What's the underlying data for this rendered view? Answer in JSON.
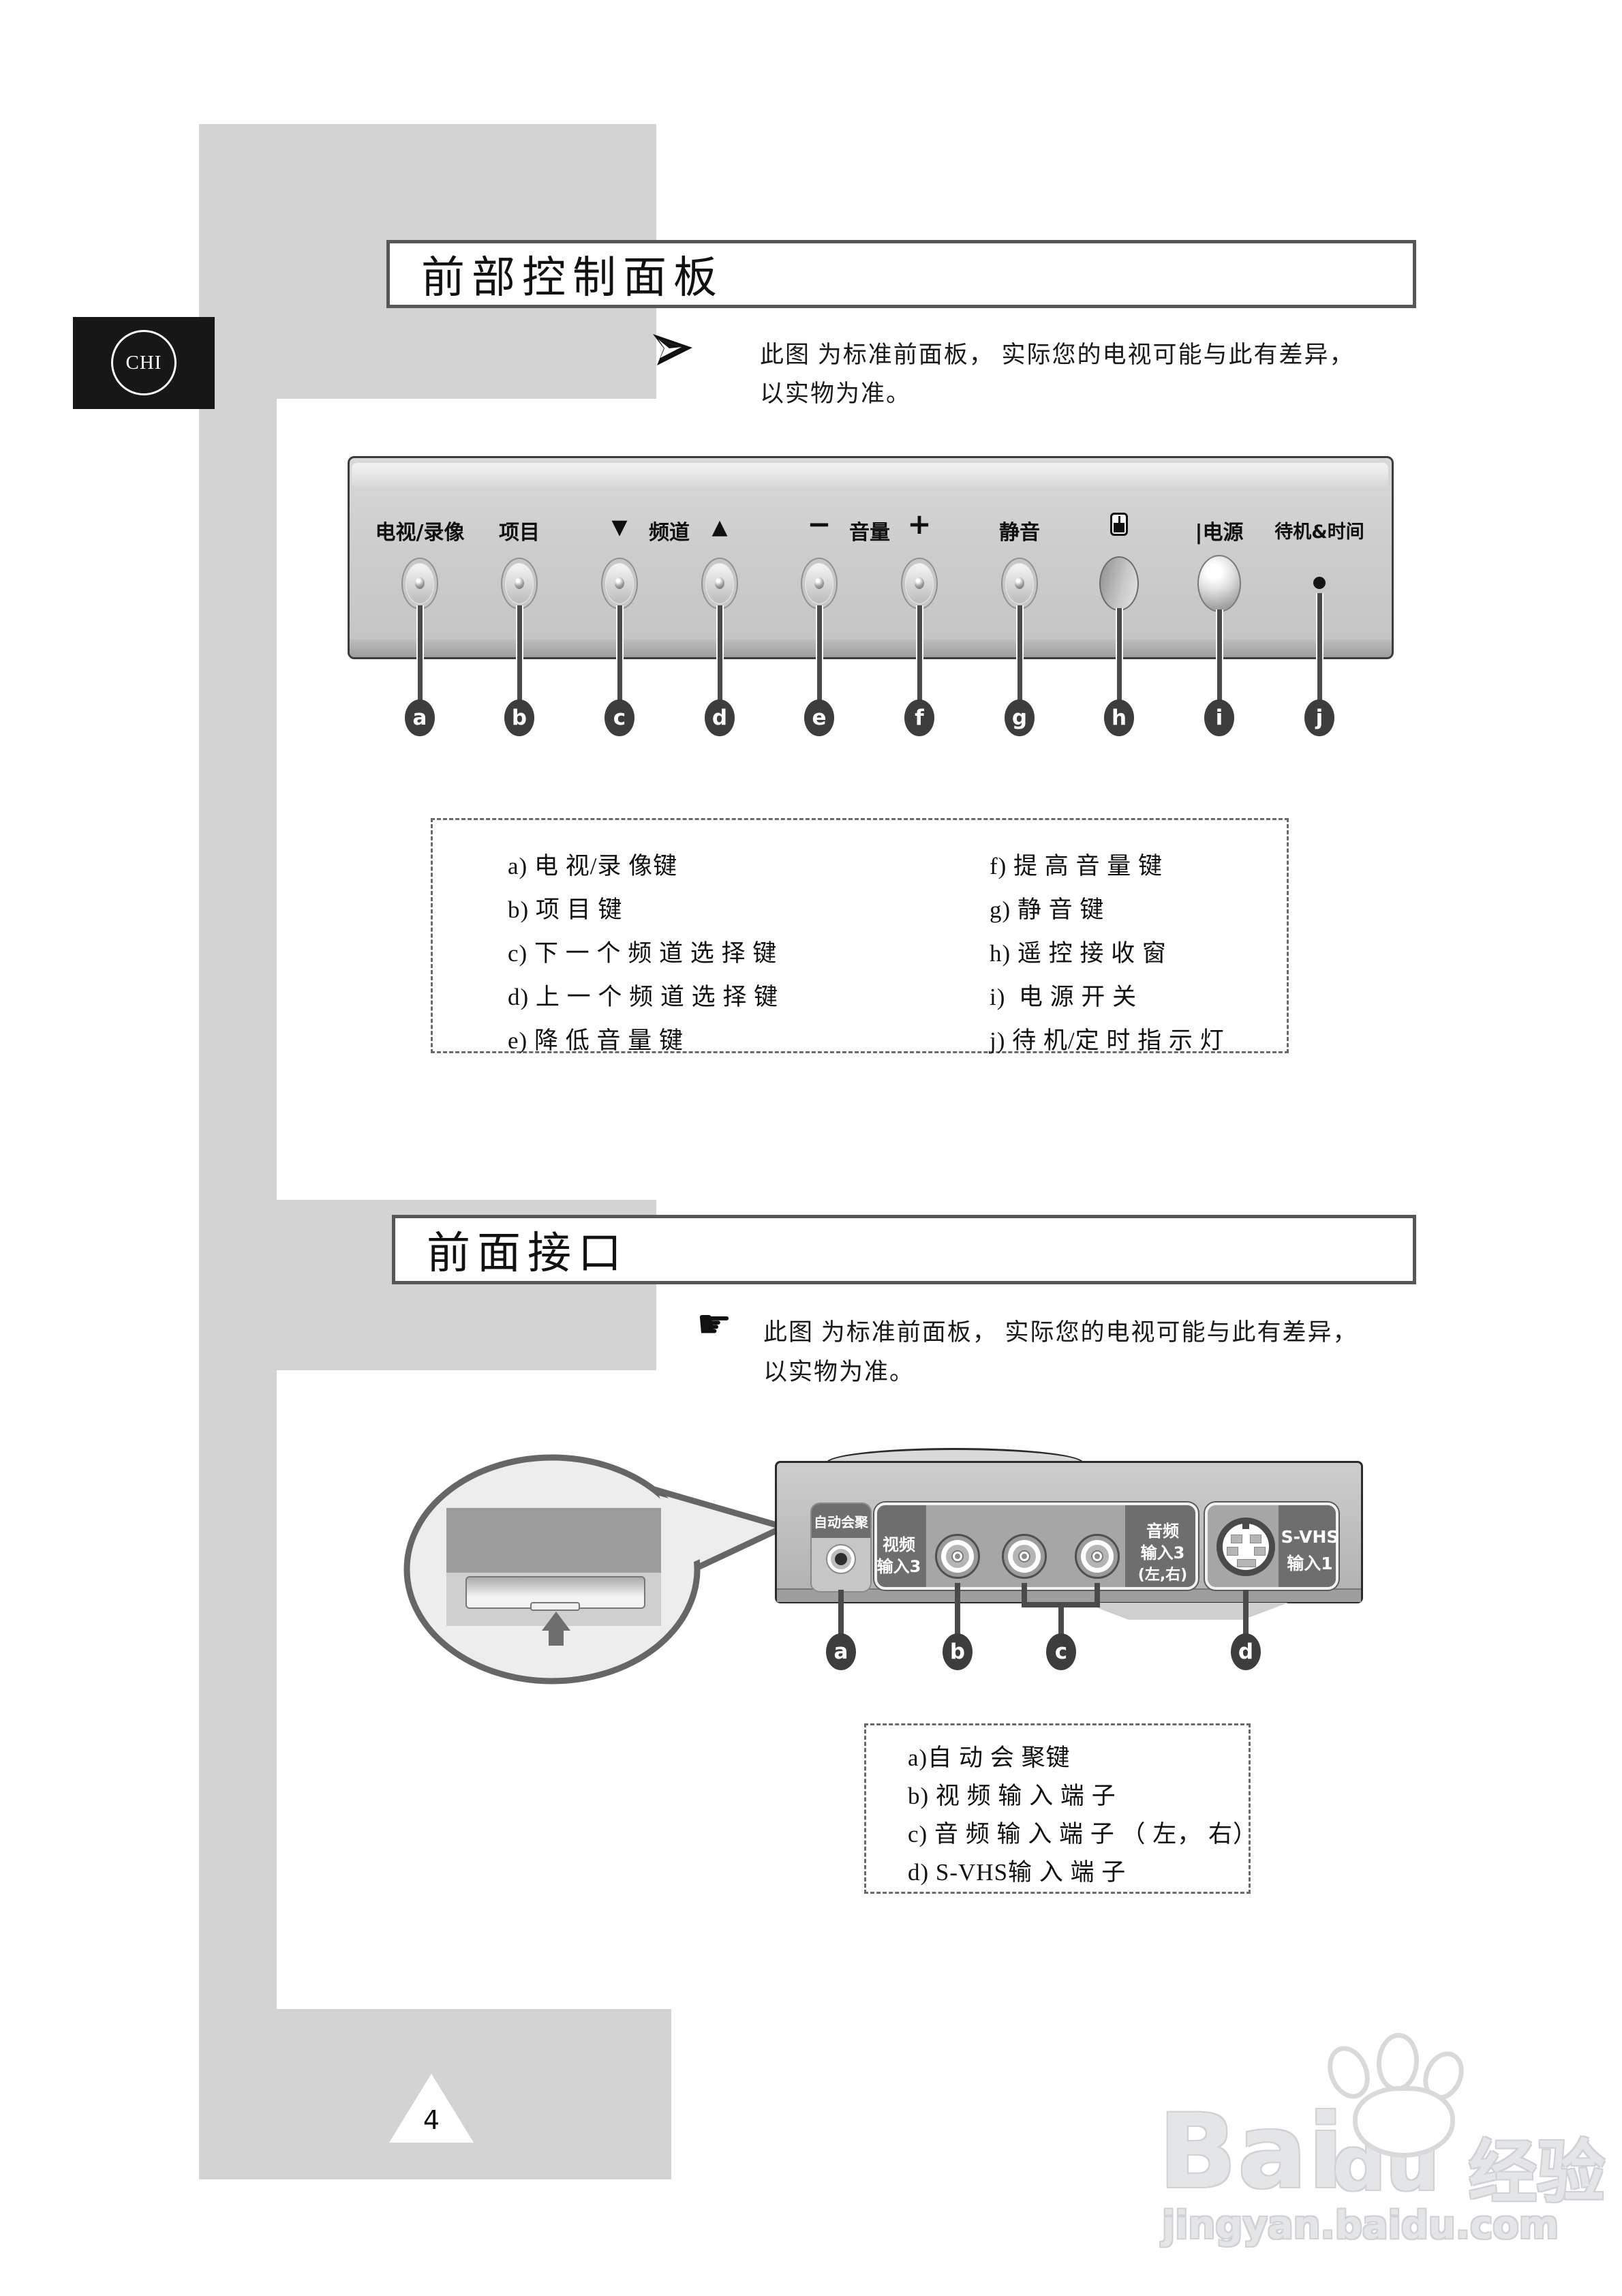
{
  "page": {
    "number": "4"
  },
  "badge": {
    "label": "CHI"
  },
  "section1": {
    "title": "前部控制面板",
    "note": {
      "line1": "此图 为标准前面板， 实际您的电视可能与此有差异，",
      "line2": "以实物为准。"
    },
    "panel": {
      "labels": {
        "tv_vcr": "电视/录像",
        "menu": "项目",
        "ch_down": "▼",
        "channel": "频道",
        "ch_up": "▲",
        "vol_minus": "−",
        "volume": "音量",
        "vol_plus": "+",
        "mute": "静音",
        "power": "|电源",
        "standby": "待机&时间"
      },
      "letters": [
        "a",
        "b",
        "c",
        "d",
        "e",
        "f",
        "g",
        "h",
        "i",
        "j"
      ]
    },
    "legend": {
      "left": [
        "a) 电 视/录 像键",
        "b) 项 目 键",
        "c) 下 一 个 频 道 选 择 键",
        "d) 上 一 个 频 道 选 择 键",
        "e) 降 低 音 量 键"
      ],
      "right": [
        "f) 提 高 音 量 键",
        "g) 静 音 键",
        "h) 遥 控 接 收 窗",
        "i)  电 源 开 关",
        "j) 待 机/定 时 指 示 灯"
      ]
    }
  },
  "section2": {
    "title": "前面接口",
    "note": {
      "icon_char": "☛",
      "line1": "此图 为标准前面板， 实际您的电视可能与此有差异，",
      "line2": "以实物为准。"
    },
    "panel": {
      "auto_converge": "自动会聚",
      "video_in": [
        "视频",
        "输入3"
      ],
      "audio_in": [
        "音频",
        "输入3",
        "(左,右)"
      ],
      "svhs_in": [
        "S-VHS",
        "输入1"
      ],
      "letters": [
        "a",
        "b",
        "c",
        "d"
      ]
    },
    "legend": [
      "a)自 动 会 聚键",
      "b) 视 频 输 入 端 子",
      "c) 音 频 输 入 端 子 （ 左， 右）",
      "d) S-VHS输 入 端 子"
    ]
  },
  "watermark": {
    "brand": "Bai",
    "brand2": "du",
    "brand_cn": "经验",
    "url": "jingyan.baidu.com"
  }
}
